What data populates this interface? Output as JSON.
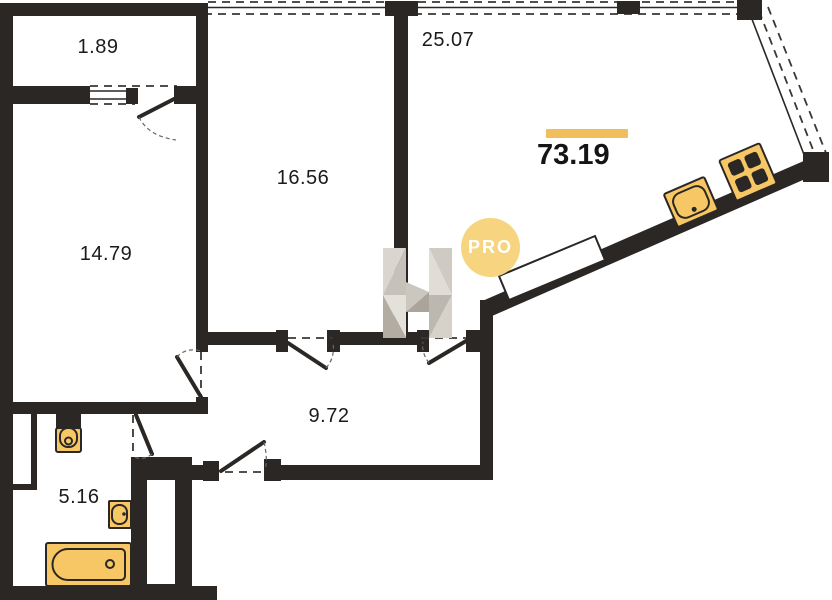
{
  "plan": {
    "title": "apartment-floor-plan",
    "total_area": {
      "value": "73.19"
    },
    "rooms": [
      {
        "id": "balcony",
        "area": "1.89"
      },
      {
        "id": "living-room",
        "area": "25.07"
      },
      {
        "id": "bedroom",
        "area": "16.56"
      },
      {
        "id": "room",
        "area": "14.79"
      },
      {
        "id": "corridor",
        "area": "9.72"
      },
      {
        "id": "bathroom",
        "area": "5.16"
      }
    ],
    "watermark": {
      "badge_text": "PRO",
      "logo": "n-logo"
    },
    "icons": [
      "bathtub-icon",
      "toilet-icon",
      "sink-icon",
      "kitchen-sink-icon",
      "stove-icon",
      "door-arc",
      "window-lines"
    ],
    "colors": {
      "wall": "#2a2725",
      "fixture_fill": "#f7c766",
      "fixture_stroke": "#2a2725",
      "accent_bar": "#f2be5c",
      "badge_fill": "#f6d480",
      "badge_text": "#ffffff",
      "logo_gray_light": "#e4e1db",
      "logo_gray_mid": "#c9c4bc",
      "logo_gray_dark": "#b0aaa1"
    }
  }
}
